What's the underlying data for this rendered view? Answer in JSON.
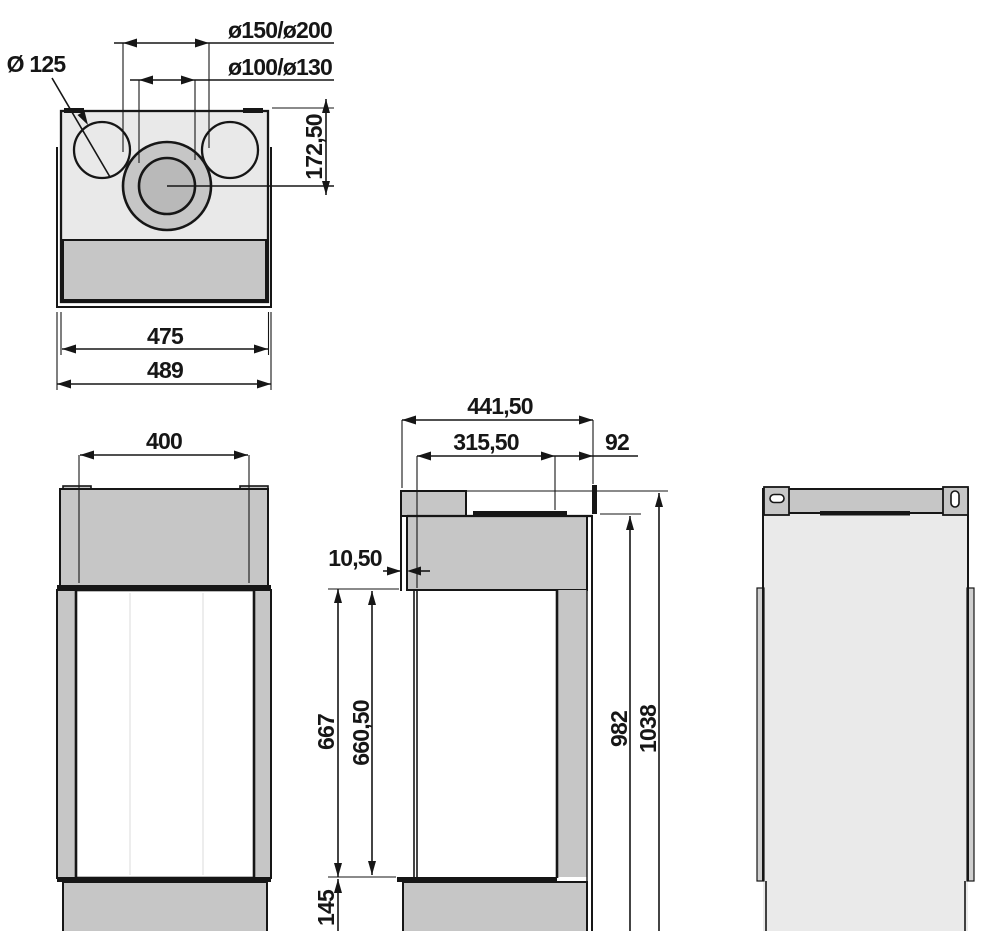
{
  "drawing": {
    "kind": "fireplace dimensional drawing",
    "colors": {
      "line": "#161616",
      "panel_mid_gray": "#c6c6c6",
      "panel_light_gray": "#e9e9e9",
      "flue_inner_gray": "#b9b9b9",
      "rail_gray": "#cfcfcf",
      "plate_black": "#161616",
      "glass_white": "#ffffff"
    },
    "views": {
      "top": {
        "dims": {
          "duct_concentric_outer": "ø150/ø200",
          "duct_concentric_inner": "ø100/ø130",
          "duct_side": "Ø 125",
          "flue_center_depth": "172,50",
          "width_inner": "475",
          "width_overall": "489"
        }
      },
      "front": {
        "dims": {
          "glass_width": "400"
        }
      },
      "side": {
        "dims": {
          "depth_overall": "441,50",
          "depth_glass_to_rear": "315,50",
          "depth_rear": "92",
          "front_lip_offset": "10,50",
          "glass_height_outer": "667",
          "glass_height_inner": "660,50",
          "base_height": "145",
          "height_to_top_plate": "982",
          "height_overall": "1038"
        }
      }
    }
  }
}
